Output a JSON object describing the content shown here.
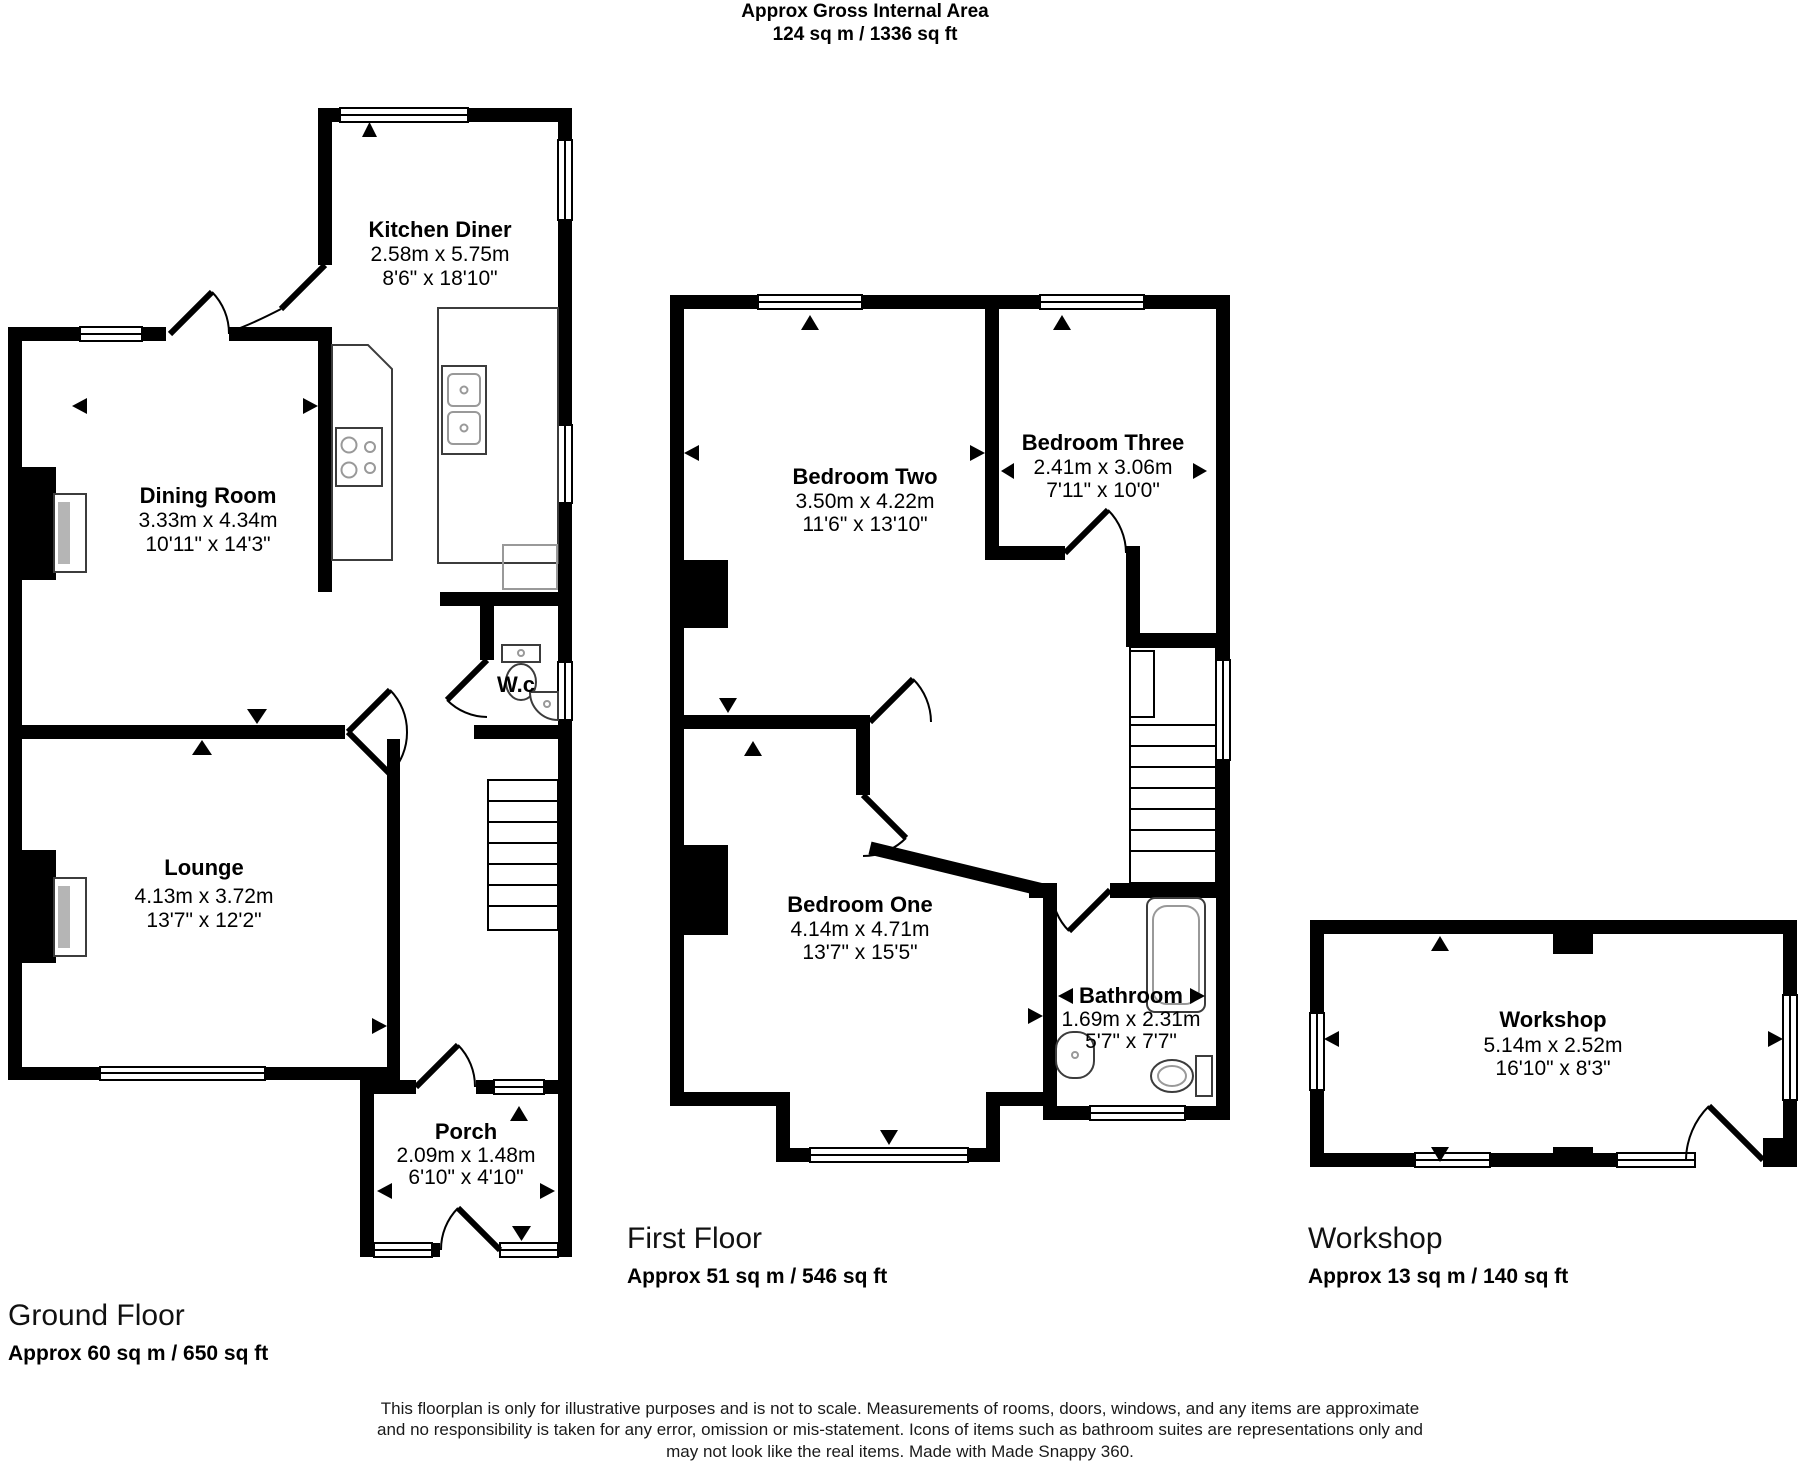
{
  "header": {
    "title": "Approx Gross Internal Area",
    "subtitle": "124 sq m / 1336 sq ft"
  },
  "rooms": {
    "kitchen_diner": {
      "name": "Kitchen Diner",
      "metric": "2.58m x 5.75m",
      "imperial": "8'6\" x 18'10\""
    },
    "dining_room": {
      "name": "Dining Room",
      "metric": "3.33m x 4.34m",
      "imperial": "10'11\" x 14'3\""
    },
    "lounge": {
      "name": "Lounge",
      "metric": "4.13m x 3.72m",
      "imperial": "13'7\" x 12'2\""
    },
    "wc": {
      "name": "W.c"
    },
    "porch": {
      "name": "Porch",
      "metric": "2.09m x 1.48m",
      "imperial": "6'10\" x 4'10\""
    },
    "bedroom_two": {
      "name": "Bedroom Two",
      "metric": "3.50m x 4.22m",
      "imperial": "11'6\" x 13'10\""
    },
    "bedroom_three": {
      "name": "Bedroom Three",
      "metric": "2.41m x 3.06m",
      "imperial": "7'11\" x 10'0\""
    },
    "bedroom_one": {
      "name": "Bedroom One",
      "metric": "4.14m x 4.71m",
      "imperial": "13'7\" x 15'5\""
    },
    "bathroom": {
      "name": "Bathroom",
      "metric": "1.69m x 2.31m",
      "imperial": "5'7\" x 7'7\""
    },
    "workshop": {
      "name": "Workshop",
      "metric": "5.14m x 2.52m",
      "imperial": "16'10\" x 8'3\""
    }
  },
  "floors": {
    "ground": {
      "title": "Ground Floor",
      "area": "Approx 60 sq m / 650 sq ft"
    },
    "first": {
      "title": "First Floor",
      "area": "Approx 51 sq m / 546 sq ft"
    },
    "workshop": {
      "title": "Workshop",
      "area": "Approx 13 sq m / 140 sq ft"
    }
  },
  "disclaimer": {
    "line1": "This floorplan is only for illustrative purposes and is not to scale. Measurements of rooms, doors, windows, and any items are approximate",
    "line2": "and no responsibility is taken for any error, omission or mis-statement. Icons of items such as bathroom suites are representations only and",
    "line3": "may not look like the real items. Made with Made Snappy 360."
  },
  "colors": {
    "wall": "#000000",
    "fixture_line": "#3c3c3c",
    "fireplace_grey": "#b5b5b5",
    "background": "#ffffff"
  }
}
